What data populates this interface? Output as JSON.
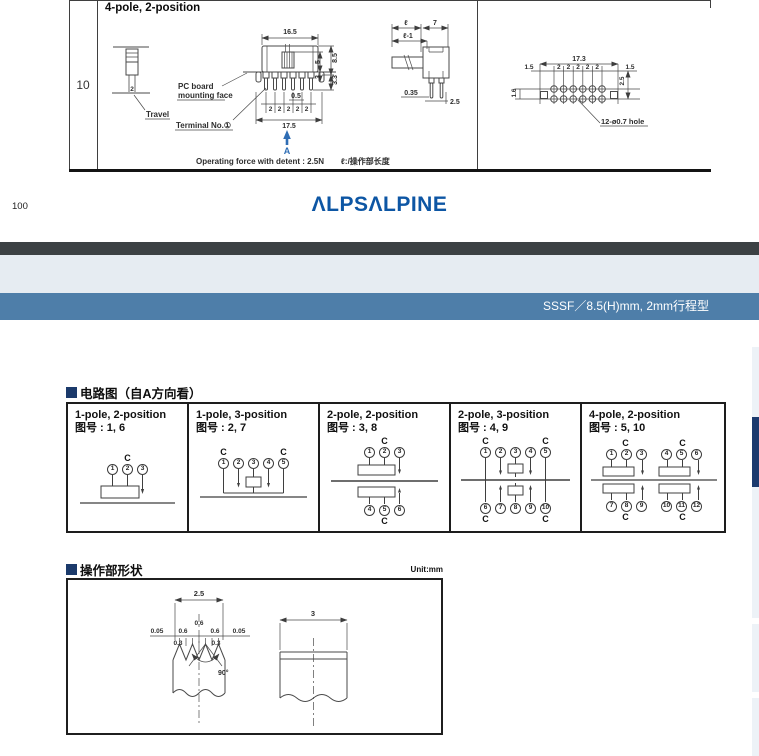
{
  "page": {
    "page_number": "100",
    "logo_text": "ALPSALPINE",
    "series_bar_label": "SSSF／8.5(H)mm, 2mm行程型"
  },
  "top_drawing": {
    "row_label": "10",
    "title": "4-pole, 2-position",
    "travel": {
      "stroke_dim": "2",
      "label": "Travel"
    },
    "front": {
      "w_top": "16.5",
      "h_knob": "5",
      "h_step": "3",
      "h_total": "8.5",
      "h_pin": "3.3",
      "pin_w": "0.5",
      "pitch": "2",
      "w_bottom": "17.5",
      "pcb_line1": "PC board",
      "pcb_line2": "mounting face",
      "terminal": "Terminal No.①",
      "view_label": "A",
      "force_note": "Operating force with detent : 2.5N",
      "len_note": "ℓ:/操作部长度"
    },
    "side": {
      "len": "ℓ",
      "w7": "7",
      "len_minus": "ℓ-1",
      "t035": "0.35",
      "p25": "2.5"
    },
    "pcb": {
      "w173": "17.3",
      "m15_left": "1.5",
      "m15_right": "1.5",
      "pitch": "2",
      "v25": "2.5",
      "v16": "1.6",
      "hole_note": "12-ø0.7 hole"
    }
  },
  "circuit_section": {
    "heading": "电路图（自A方向看）",
    "cells": [
      {
        "title": "1-pole, 2-position",
        "fig": "图号 : 1, 6",
        "c_top": [
          "",
          "C",
          ""
        ],
        "top_nums": [
          "1",
          "2",
          "3"
        ],
        "bottom_nums": [],
        "c_bottom": []
      },
      {
        "title": "1-pole, 3-position",
        "fig": "图号 : 2, 7",
        "c_top": [
          "C",
          "",
          "",
          "",
          "C"
        ],
        "top_nums": [
          "1",
          "2",
          "3",
          "4",
          "5"
        ],
        "bottom_nums": [],
        "c_bottom": []
      },
      {
        "title": "2-pole, 2-position",
        "fig": "图号 : 3, 8",
        "c_top": [
          "",
          "C",
          ""
        ],
        "top_nums": [
          "1",
          "2",
          "3"
        ],
        "bottom_nums": [
          "4",
          "5",
          "6"
        ],
        "c_bottom": [
          "",
          "C",
          ""
        ]
      },
      {
        "title": "2-pole, 3-position",
        "fig": "图号 : 4, 9",
        "c_top": [
          "C",
          "",
          "",
          "",
          "C"
        ],
        "top_nums": [
          "1",
          "2",
          "3",
          "4",
          "5"
        ],
        "bottom_nums": [
          "6",
          "7",
          "8",
          "9",
          "10"
        ],
        "c_bottom": [
          "C",
          "",
          "",
          "",
          "C"
        ]
      },
      {
        "title": "4-pole, 2-position",
        "fig": "图号 : 5, 10",
        "c_top": [
          "",
          "C",
          "",
          "",
          "C",
          ""
        ],
        "top_nums": [
          "1",
          "2",
          "3",
          "4",
          "5",
          "6"
        ],
        "bottom_nums": [
          "7",
          "8",
          "9",
          "10",
          "11",
          "12"
        ],
        "c_bottom": [
          "",
          "C",
          "",
          "",
          "C",
          ""
        ]
      }
    ]
  },
  "shape_section": {
    "heading": "操作部形状",
    "unit": "Unit:mm",
    "left": {
      "w25": "2.5",
      "s005l": "0.05",
      "s06l": "0.6",
      "s06m": "0.6",
      "s06r": "0.6",
      "s005r": "0.05",
      "s03l": "0.3",
      "s03r": "0.3",
      "angle": "90°"
    },
    "right": {
      "w3": "3"
    }
  }
}
